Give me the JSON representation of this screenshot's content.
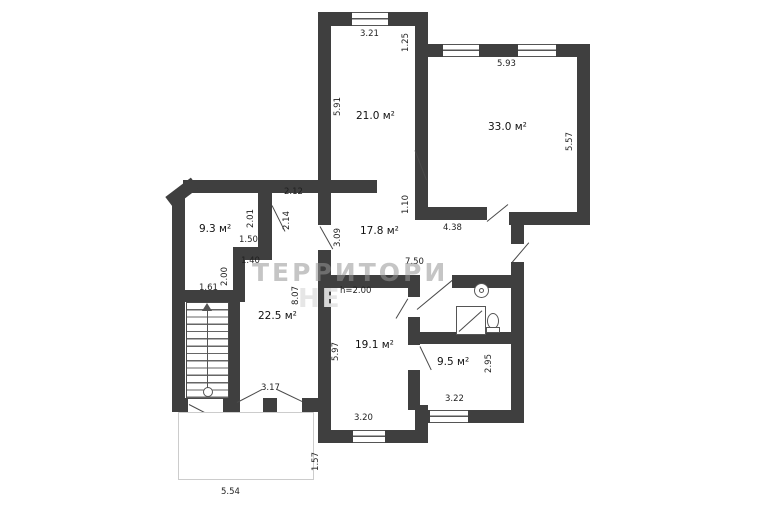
{
  "plan": {
    "title": "apartment-floor-plan",
    "watermark": {
      "line1": "ТЕРРИТОРИ",
      "line2": "НЕ"
    },
    "colors": {
      "wall": "#3f3f3f",
      "dim_text": "#1f1f1f",
      "watermark": "#969696",
      "porch_outline": "#cccccc"
    },
    "rooms": [
      {
        "id": "room-top-left",
        "area_label": "21.0 м²"
      },
      {
        "id": "room-top-right",
        "area_label": "33.0 м²"
      },
      {
        "id": "room-small-nw",
        "area_label": "9.3 м²"
      },
      {
        "id": "hall-center",
        "area_label": "17.8 м²"
      },
      {
        "id": "room-west",
        "area_label": "22.5 м²"
      },
      {
        "id": "room-south",
        "area_label": "19.1 м²"
      },
      {
        "id": "room-south-east",
        "area_label": "9.5 м²"
      }
    ],
    "dimensions": {
      "d321": "3.21",
      "d125": "1.25",
      "d593": "5.93",
      "d591": "5.91",
      "d557": "5.57",
      "d212": "2.12",
      "d201": "2.01",
      "d214": "2.14",
      "d150": "1.50",
      "d140": "1.40",
      "d200": "2.00",
      "d161": "1.61",
      "d110": "1.10",
      "d438": "4.38",
      "d750": "7.50",
      "d309": "3.09",
      "d807": "8.07",
      "dh200": "h=2.00",
      "d597": "5.97",
      "d317": "3.17",
      "d320": "3.20",
      "d322": "3.22",
      "d295": "2.95",
      "d157": "1.57",
      "d554": "5.54"
    },
    "fixtures": [
      "sink",
      "shower",
      "toilet"
    ],
    "stairs": {
      "direction": "up"
    }
  }
}
